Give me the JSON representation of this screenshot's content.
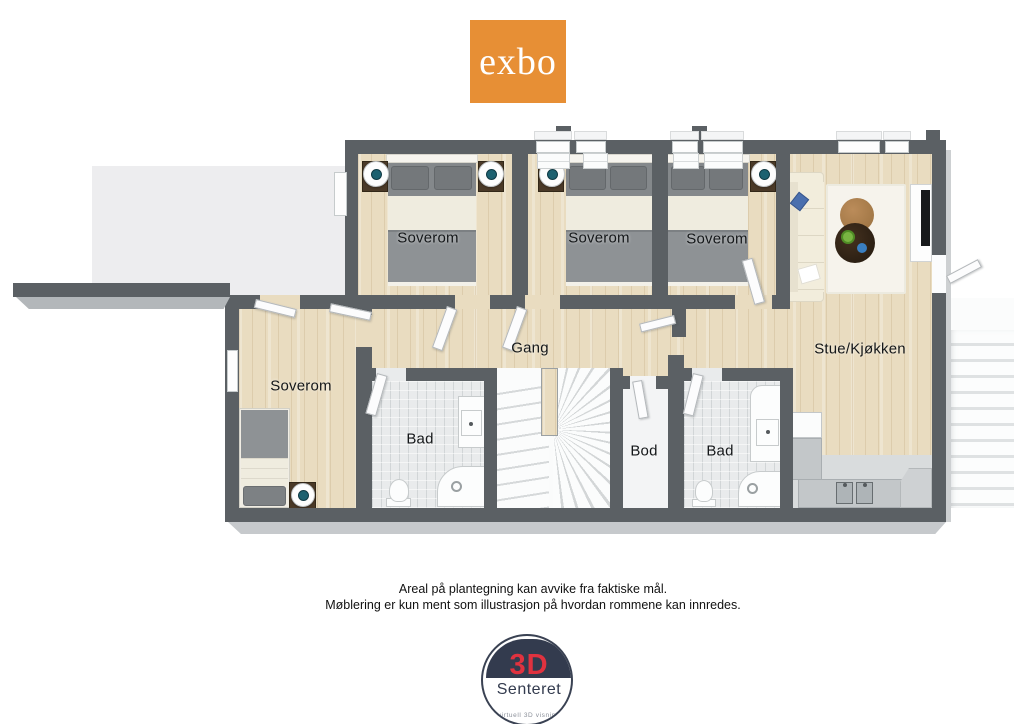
{
  "brand": {
    "logo_text": "exbo",
    "logo_color": "#e78f35"
  },
  "floorplan": {
    "rooms": [
      {
        "id": "bedroom-top-1",
        "label": "Soverom"
      },
      {
        "id": "bedroom-top-2",
        "label": "Soverom"
      },
      {
        "id": "bedroom-top-3",
        "label": "Soverom"
      },
      {
        "id": "bedroom-left",
        "label": "Soverom"
      },
      {
        "id": "hallway",
        "label": "Gang"
      },
      {
        "id": "living-kitchen",
        "label": "Stue/Kjøkken"
      },
      {
        "id": "bathroom-1",
        "label": "Bad"
      },
      {
        "id": "storage",
        "label": "Bod"
      },
      {
        "id": "bathroom-2",
        "label": "Bad"
      }
    ],
    "colors": {
      "wall": "#5b6064",
      "wood_floor": "#e9dcc0",
      "tile_floor": "#e9ebec",
      "terrace": "#ededef"
    }
  },
  "disclaimer": {
    "line1": "Areal på plantegning kan avvike fra faktiske mål.",
    "line2": "Møblering er kun ment som illustrasjon på hvordan rommene kan innredes."
  },
  "footer_logo": {
    "top": "3D",
    "name": "Senteret",
    "tagline": "virtuell 3D visning",
    "navy": "#333b4e",
    "red": "#e0323f"
  }
}
